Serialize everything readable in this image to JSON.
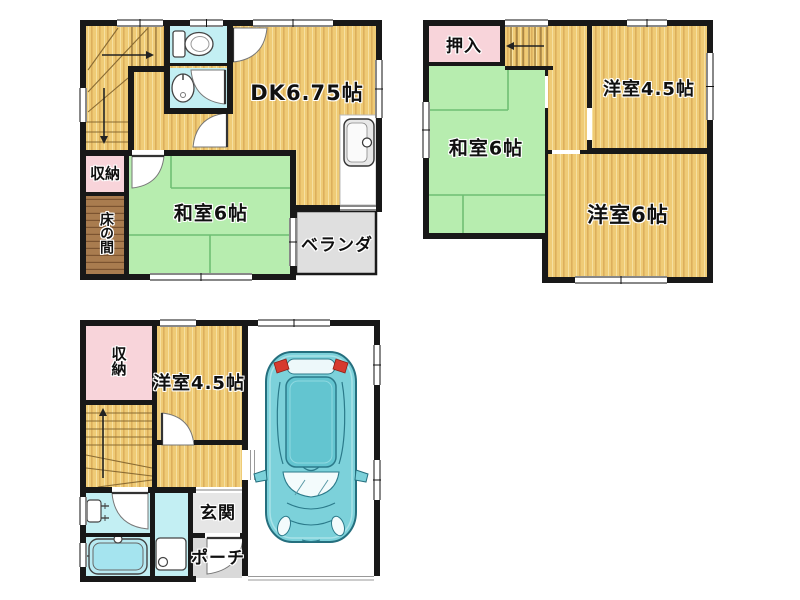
{
  "plans": {
    "top_left": {
      "rooms": {
        "dk": "DK6.75帖",
        "washitsu": "和室6帖",
        "closet": "収納",
        "tokonoma": "床の間",
        "veranda": "ベランダ"
      }
    },
    "top_right": {
      "rooms": {
        "oshiire": "押入",
        "washitsu": "和室6帖",
        "yoshitsu_45": "洋室4.5帖",
        "yoshitsu_6": "洋室6帖"
      }
    },
    "bottom_left": {
      "rooms": {
        "closet": "収納",
        "yoshitsu_45": "洋室4.5帖",
        "genkan": "玄関",
        "porch": "ポーチ"
      }
    }
  },
  "colors": {
    "wall": "#181818",
    "wood_floor": "#EFCB76",
    "wood_stripe": "#D8A855",
    "tatami_green": "#B7EDAF",
    "tatami_line": "#6FBF73",
    "wet_area_cyan": "#C3EFF3",
    "closet_pink": "#F8D4DA",
    "tokonoma_brown": "#A97C4F",
    "veranda_gray": "#DFDFDF",
    "genkan_gray": "#E6E6E6",
    "porch_gray": "#D9D9D9",
    "car_body_teal": "#7CD1DA",
    "car_roof_teal": "#63C5D0",
    "tail_light_red": "#D63A2F"
  }
}
